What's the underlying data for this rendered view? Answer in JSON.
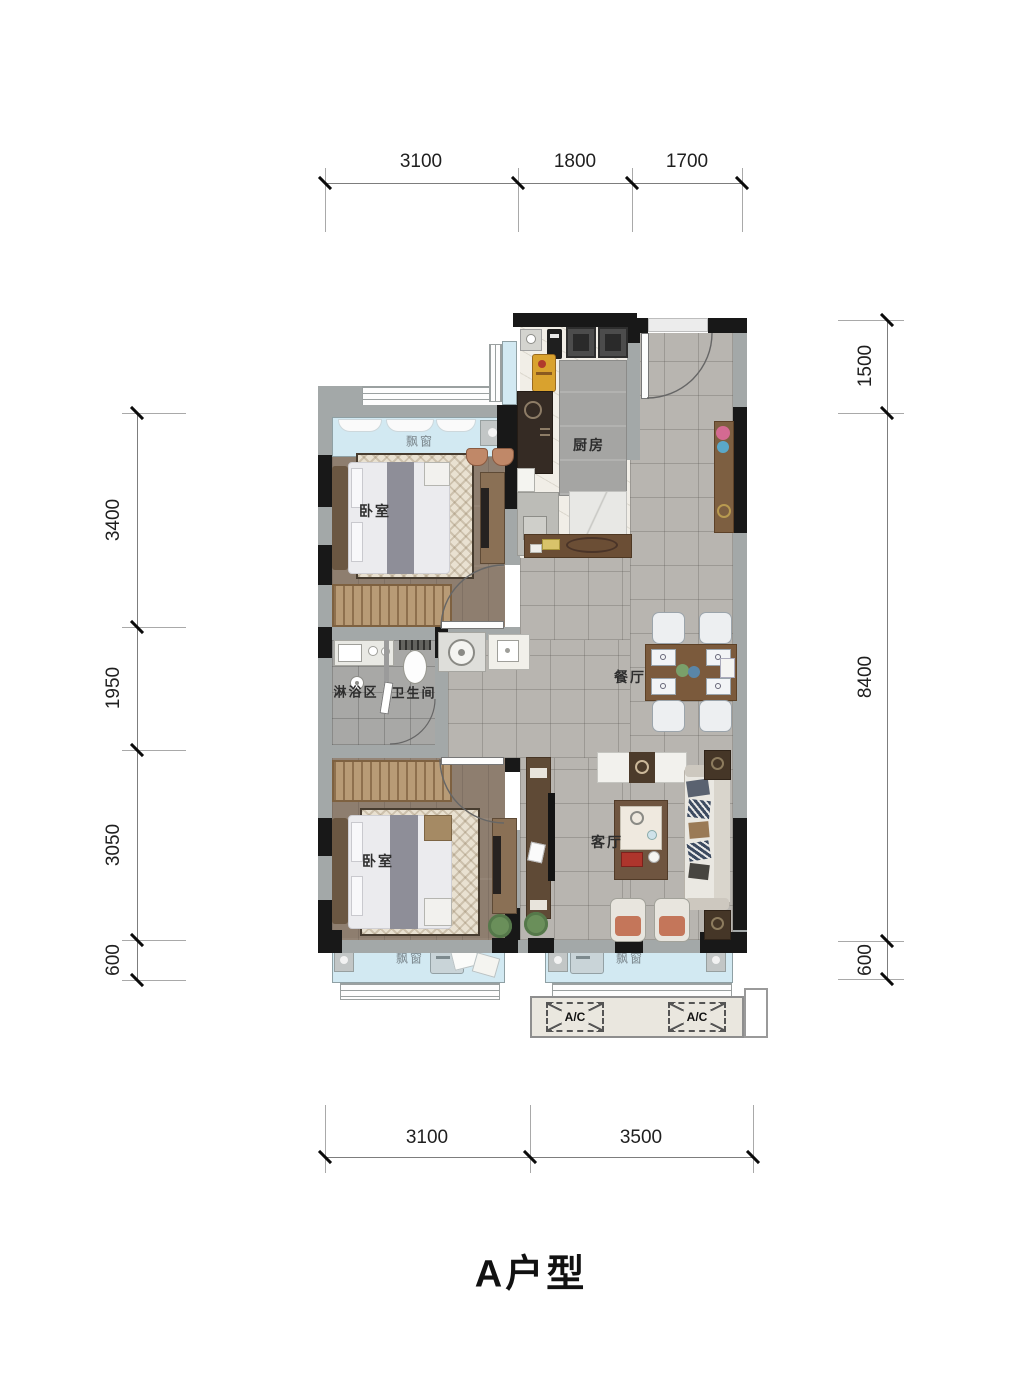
{
  "title": "A户型",
  "dims": {
    "top": [
      "3100",
      "1800",
      "1700"
    ],
    "bottom": [
      "3100",
      "3500"
    ],
    "left": [
      "3400",
      "1950",
      "3050",
      "600"
    ],
    "right": [
      "1500",
      "8400",
      "600"
    ]
  },
  "rooms": {
    "bay_window_top": "飘窗",
    "bedroom1": "卧室",
    "kitchen": "厨房",
    "dining": "餐厅",
    "shower": "淋浴区",
    "toilet": "卫生间",
    "bedroom2": "卧室",
    "living": "客厅",
    "bay_window_bottom_left": "飘窗",
    "bay_window_bottom_right": "飘窗"
  },
  "ac": {
    "left": "A/C",
    "right": "A/C"
  },
  "colors": {
    "wall_black": "#181818",
    "wall_gray": "#a3a8a8",
    "bay_window_blue": "#d2e9f2",
    "wood_floor": "#8e7e6f",
    "tile_floor": "#b8b5b0",
    "marble_floor": "#f1eee7",
    "bathroom_floor": "#a8a8a6",
    "table_wood": "#7b5a3c",
    "dim_text": "#1f1f1f"
  }
}
